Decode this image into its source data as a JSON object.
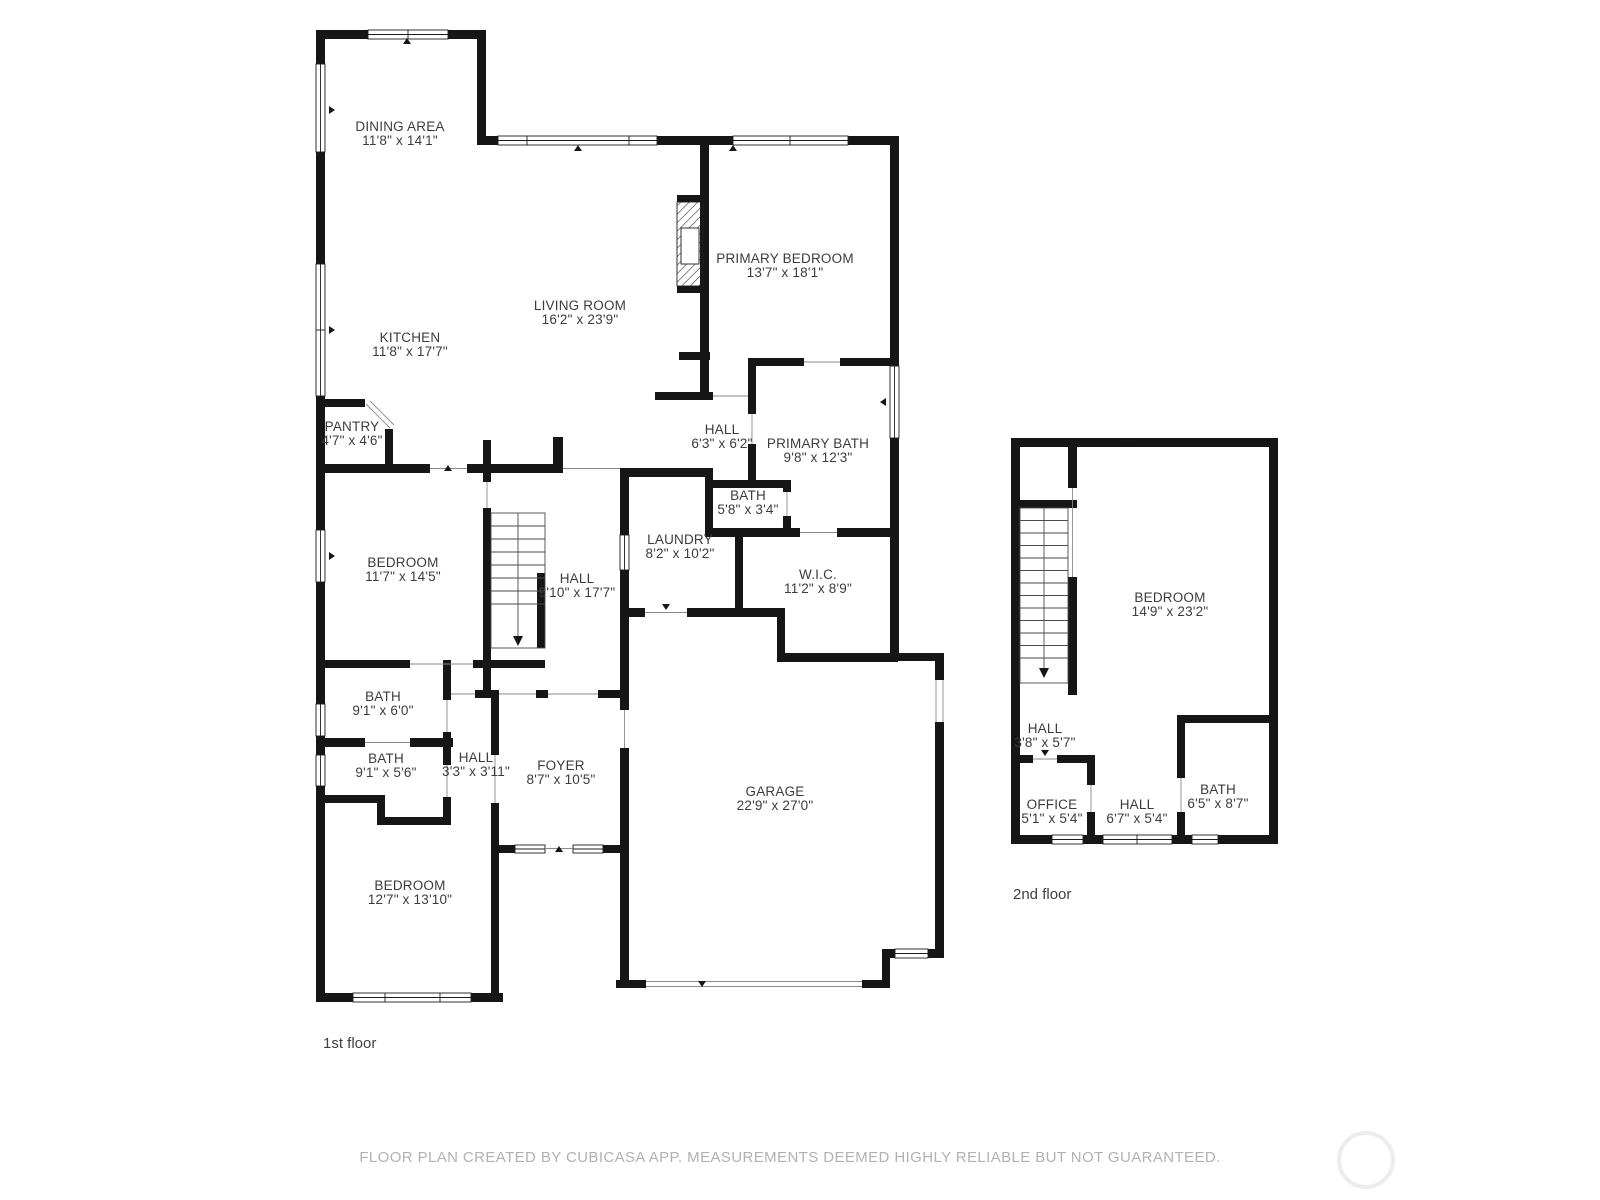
{
  "footer": {
    "text": "FLOOR PLAN CREATED BY CUBICASA APP. MEASUREMENTS DEEMED HIGHLY RELIABLE BUT NOT GUARANTEED."
  },
  "colors": {
    "wall": "#161616",
    "label": "#3c3c3c",
    "footer_text": "#b1b1b1",
    "watermark": "#ededed"
  },
  "floor1": {
    "label": "1st floor",
    "rooms": [
      {
        "name": "DINING AREA",
        "dims": "11'8\" x 14'1\""
      },
      {
        "name": "PRIMARY BEDROOM",
        "dims": "13'7\" x 18'1\""
      },
      {
        "name": "LIVING ROOM",
        "dims": "16'2\" x 23'9\""
      },
      {
        "name": "KITCHEN",
        "dims": "11'8\" x 17'7\""
      },
      {
        "name": "PANTRY",
        "dims": "4'7\" x 4'6\""
      },
      {
        "name": "HALL",
        "dims": "6'3\" x 6'2\""
      },
      {
        "name": "PRIMARY BATH",
        "dims": "9'8\" x 12'3\""
      },
      {
        "name": "BATH",
        "dims": "5'8\" x 3'4\""
      },
      {
        "name": "LAUNDRY",
        "dims": "8'2\" x 10'2\""
      },
      {
        "name": "BEDROOM",
        "dims": "11'7\" x 14'5\""
      },
      {
        "name": "HALL",
        "dims": "9'10\" x 17'7\""
      },
      {
        "name": "W.I.C.",
        "dims": "11'2\" x 8'9\""
      },
      {
        "name": "BATH",
        "dims": "9'1\" x 6'0\""
      },
      {
        "name": "BATH",
        "dims": "9'1\" x 5'6\""
      },
      {
        "name": "HALL",
        "dims": "3'3\" x 3'11\""
      },
      {
        "name": "FOYER",
        "dims": "8'7\" x 10'5\""
      },
      {
        "name": "GARAGE",
        "dims": "22'9\" x 27'0\""
      },
      {
        "name": "BEDROOM",
        "dims": "12'7\" x 13'10\""
      }
    ]
  },
  "floor2": {
    "label": "2nd floor",
    "rooms": [
      {
        "name": "BEDROOM",
        "dims": "14'9\" x 23'2\""
      },
      {
        "name": "HALL",
        "dims": "3'8\" x 5'7\""
      },
      {
        "name": "OFFICE",
        "dims": "5'1\" x 5'4\""
      },
      {
        "name": "HALL",
        "dims": "6'7\" x 5'4\""
      },
      {
        "name": "BATH",
        "dims": "6'5\" x 8'7\""
      }
    ]
  }
}
